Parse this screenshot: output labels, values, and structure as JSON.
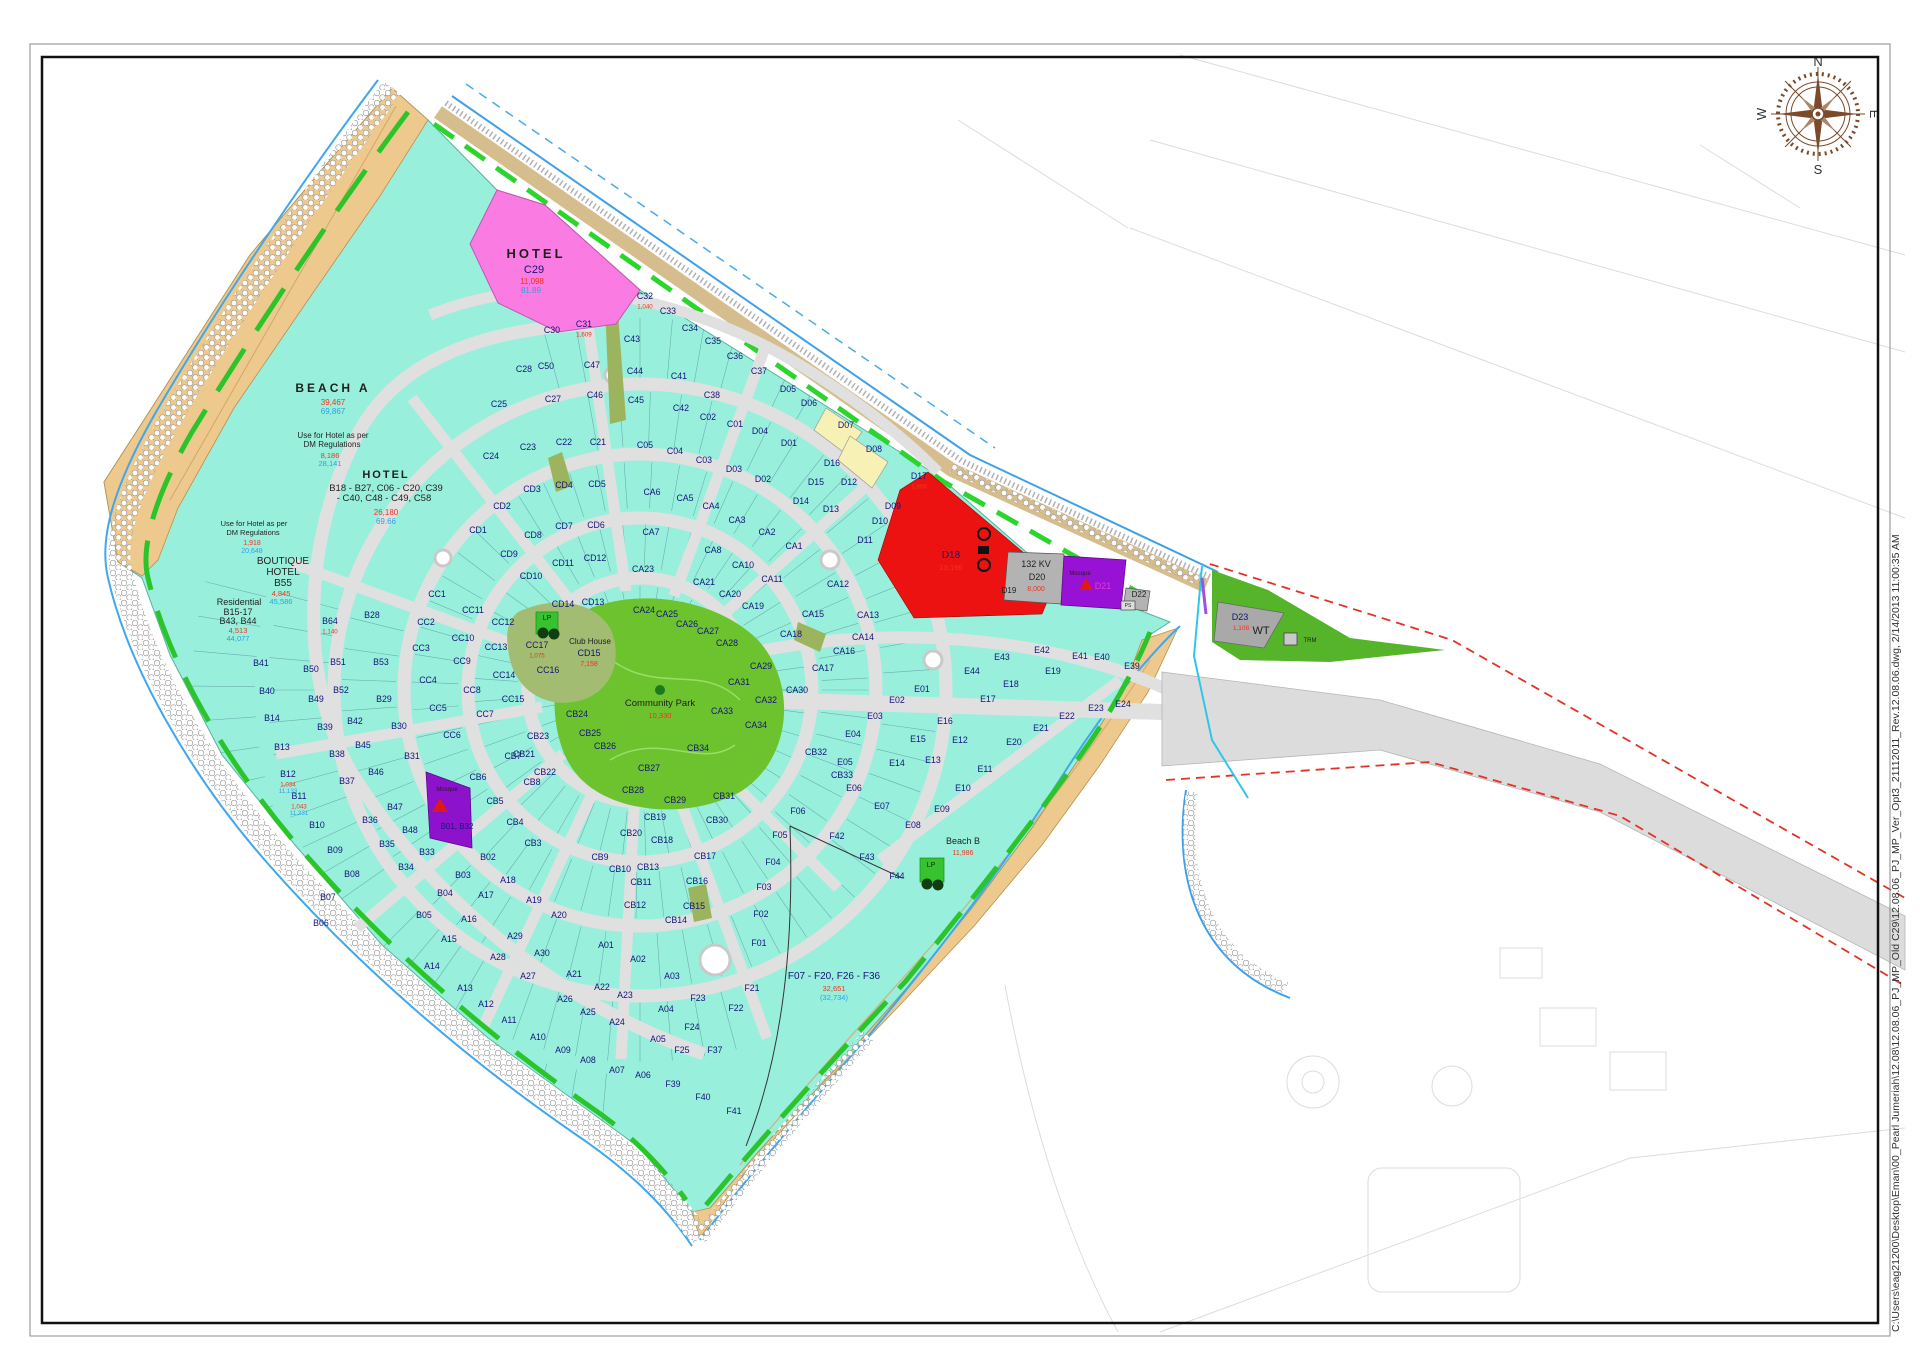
{
  "file_stamp": "C:\\Users\\eag21200\\Desktop\\Eman\\00_Pearl Jumeriah\\12.08\\12.08.06_PJ_MP_Old C29\\12.08.06_PJ_MP_Ver_Opt3_21112011_Rev.12.08.06.dwg, 2/14/2013 11:00:35 AM",
  "compass": {
    "n": "N",
    "e": "E",
    "s": "S",
    "w": "W"
  },
  "palette": {
    "plot_teal": "#98f0dc",
    "beach_tan": "#edc98e",
    "hotel_pink": "#fa7ce2",
    "utility_red": "#ed1212",
    "mosque_purple": "#9712d4",
    "park_green": "#6dc32d",
    "road_gray": "#e0e0e0",
    "code_navy": "#141478",
    "area_red": "#f2331e",
    "area_blue": "#2e9fe6"
  },
  "labels": [
    [
      "HOTEL",
      536,
      258,
      13,
      "k",
      1,
      3
    ],
    [
      "C29",
      534,
      273,
      11,
      "n",
      0,
      0
    ],
    [
      "11,098",
      532,
      284,
      8,
      "r",
      0,
      0
    ],
    [
      "81.89",
      531,
      293,
      8,
      "b",
      0,
      0
    ],
    [
      "BEACH A",
      333,
      392,
      12,
      "k",
      1,
      3
    ],
    [
      "39,467",
      333,
      405,
      8,
      "r",
      0,
      0
    ],
    [
      "69,867",
      333,
      414,
      8,
      "b",
      0,
      0
    ],
    [
      "Use for Hotel as per",
      333,
      438,
      8,
      "k",
      0,
      0
    ],
    [
      "DM Regulations",
      332,
      447,
      8,
      "k",
      0,
      0
    ],
    [
      "8,186",
      330,
      458,
      7.5,
      "r",
      0,
      0
    ],
    [
      "28,141",
      330,
      466,
      7.5,
      "b",
      0,
      0
    ],
    [
      "HOTEL",
      386,
      478,
      11,
      "k",
      1,
      2
    ],
    [
      "B18 - B27, C06 - C20, C39",
      386,
      491,
      9.5,
      "k",
      0,
      0
    ],
    [
      "- C40, C48 - C49, C58",
      384,
      501,
      9.5,
      "k",
      0,
      0
    ],
    [
      "26,180",
      386,
      515,
      8,
      "r",
      0,
      0
    ],
    [
      "69.66",
      386,
      524,
      8,
      "b",
      0,
      0
    ],
    [
      "Use for Hotel as per",
      254,
      526,
      7.5,
      "k",
      0,
      0
    ],
    [
      "DM Regulations",
      253,
      535,
      7.5,
      "k",
      0,
      0
    ],
    [
      "1,918",
      252,
      545,
      7,
      "r",
      0,
      0
    ],
    [
      "20,648",
      252,
      553,
      7,
      "b",
      0,
      0
    ],
    [
      "BOUTIQUE",
      283,
      564,
      10,
      "k",
      0,
      0
    ],
    [
      "HOTEL",
      283,
      575,
      10,
      "k",
      0,
      0
    ],
    [
      "B55",
      283,
      586,
      10,
      "k",
      0,
      0
    ],
    [
      "4,845",
      281,
      596,
      7.5,
      "r",
      0,
      0
    ],
    [
      "45,586",
      281,
      604,
      7.5,
      "b",
      0,
      0
    ],
    [
      "Residential",
      239,
      605,
      9,
      "k",
      0,
      0
    ],
    [
      "B15-17",
      238,
      615,
      9,
      "k",
      0,
      0
    ],
    [
      "B43, B44",
      238,
      624,
      9,
      "k",
      0,
      0
    ],
    [
      "4,513",
      238,
      633,
      7.5,
      "r",
      0,
      0
    ],
    [
      "44,077",
      238,
      641,
      7.5,
      "b",
      0,
      0
    ],
    [
      "D18",
      951,
      558,
      10,
      "n",
      0,
      0
    ],
    [
      "13,196",
      951,
      570,
      7.5,
      "r",
      0,
      0
    ],
    [
      "D19",
      1009,
      593,
      8,
      "k",
      0,
      0
    ],
    [
      "132 KV",
      1036,
      567,
      9,
      "k",
      0,
      0
    ],
    [
      "D20",
      1037,
      580,
      9,
      "k",
      0,
      0
    ],
    [
      "8,000",
      1036,
      591,
      7,
      "r",
      0,
      0
    ],
    [
      "Mosque",
      1080,
      575,
      6,
      "k",
      0,
      0
    ],
    [
      "D21",
      1103,
      589,
      9,
      "m",
      0,
      0
    ],
    [
      "D22",
      1139,
      597,
      8,
      "k",
      0,
      0
    ],
    [
      "PS",
      1128,
      607,
      5,
      "k",
      0,
      0
    ],
    [
      "D23",
      1240,
      620,
      9,
      "n",
      0,
      0
    ],
    [
      "1,108",
      1241,
      630,
      6.5,
      "r",
      0,
      0
    ],
    [
      "WT",
      1261,
      634,
      11,
      "k",
      0,
      0
    ],
    [
      "TRM",
      1310,
      642,
      6,
      "k",
      0,
      0
    ],
    [
      "LP",
      547,
      620,
      7,
      "k",
      0,
      0
    ],
    [
      "LP",
      931,
      867,
      7,
      "k",
      0,
      0
    ],
    [
      "Club House",
      590,
      644,
      8,
      "k",
      0,
      0
    ],
    [
      "CD15",
      589,
      656,
      9,
      "n",
      0,
      0
    ],
    [
      "7,158",
      589,
      666,
      7,
      "r",
      0,
      0
    ],
    [
      "Community Park",
      660,
      706,
      9.5,
      "k",
      0,
      0
    ],
    [
      "10,330",
      660,
      718,
      7.5,
      "r",
      0,
      0
    ],
    [
      "Beach B",
      963,
      844,
      9,
      "k",
      0,
      0
    ],
    [
      "11,986",
      963,
      855,
      7,
      "r",
      0,
      0
    ],
    [
      "F07 - F20,  F26 - F36",
      834,
      979,
      10,
      "n",
      0,
      0
    ],
    [
      "32,651",
      834,
      991,
      7.5,
      "r",
      0,
      0
    ],
    [
      "(32,734)",
      834,
      1000,
      7.5,
      "b",
      0,
      0
    ],
    [
      "Mosque",
      447,
      791,
      6,
      "k",
      0,
      0
    ],
    [
      "B01, B32",
      457,
      829,
      8,
      "n",
      0,
      0
    ]
  ],
  "plots": [
    [
      "C30",
      552,
      333
    ],
    [
      "C31",
      584,
      327,
      "1,609"
    ],
    [
      "C32",
      645,
      299,
      "1,040"
    ],
    [
      "C33",
      668,
      314
    ],
    [
      "C34",
      690,
      331
    ],
    [
      "C35",
      713,
      344
    ],
    [
      "C36",
      735,
      359
    ],
    [
      "C37",
      759,
      374
    ],
    [
      "C43",
      632,
      342
    ],
    [
      "C50",
      546,
      369
    ],
    [
      "C47",
      592,
      368
    ],
    [
      "C44",
      635,
      374
    ],
    [
      "C28",
      524,
      372
    ],
    [
      "C25",
      499,
      407
    ],
    [
      "C27",
      553,
      402
    ],
    [
      "C46",
      595,
      398
    ],
    [
      "C45",
      636,
      403
    ],
    [
      "C41",
      679,
      379
    ],
    [
      "C38",
      712,
      398
    ],
    [
      "C42",
      681,
      411
    ],
    [
      "C02",
      708,
      420
    ],
    [
      "C01",
      735,
      427
    ],
    [
      "C24",
      491,
      459
    ],
    [
      "C23",
      528,
      450
    ],
    [
      "C22",
      564,
      445
    ],
    [
      "C21",
      598,
      445
    ],
    [
      "C05",
      645,
      448
    ],
    [
      "C04",
      675,
      454
    ],
    [
      "C03",
      704,
      463
    ],
    [
      "D05",
      788,
      392
    ],
    [
      "D06",
      809,
      406
    ],
    [
      "D04",
      760,
      434
    ],
    [
      "D01",
      789,
      446
    ],
    [
      "D03",
      734,
      472
    ],
    [
      "D02",
      763,
      482
    ],
    [
      "D07",
      846,
      428
    ],
    [
      "D08",
      874,
      452
    ],
    [
      "D16",
      832,
      466
    ],
    [
      "D15",
      816,
      485
    ],
    [
      "D12",
      849,
      485
    ],
    [
      "D14",
      801,
      504
    ],
    [
      "D13",
      831,
      512
    ],
    [
      "D09",
      893,
      509
    ],
    [
      "D10",
      880,
      524
    ],
    [
      "D11",
      865,
      543
    ],
    [
      "D17",
      919,
      479,
      "1,858"
    ],
    [
      "CD1",
      478,
      533
    ],
    [
      "CD2",
      502,
      509
    ],
    [
      "CD3",
      532,
      492
    ],
    [
      "CD4",
      564,
      488
    ],
    [
      "CD5",
      597,
      487
    ],
    [
      "CD6",
      596,
      528
    ],
    [
      "CD7",
      564,
      529
    ],
    [
      "CD8",
      533,
      538
    ],
    [
      "CD9",
      509,
      557
    ],
    [
      "CD10",
      531,
      579
    ],
    [
      "CD11",
      563,
      566
    ],
    [
      "CD12",
      595,
      561
    ],
    [
      "CD13",
      593,
      605
    ],
    [
      "CD14",
      563,
      607
    ],
    [
      "CA1",
      794,
      549
    ],
    [
      "CA2",
      767,
      535
    ],
    [
      "CA3",
      737,
      523
    ],
    [
      "CA4",
      711,
      509
    ],
    [
      "CA5",
      685,
      501
    ],
    [
      "CA6",
      652,
      495
    ],
    [
      "CA7",
      651,
      535
    ],
    [
      "CA8",
      713,
      553
    ],
    [
      "CA10",
      743,
      568
    ],
    [
      "CA11",
      772,
      582
    ],
    [
      "CA12",
      838,
      587
    ],
    [
      "CA13",
      868,
      618
    ],
    [
      "CA14",
      863,
      640
    ],
    [
      "CA15",
      813,
      617
    ],
    [
      "CA16",
      844,
      654
    ],
    [
      "CA17",
      823,
      671
    ],
    [
      "CA18",
      791,
      637
    ],
    [
      "CA19",
      753,
      609
    ],
    [
      "CA20",
      730,
      597
    ],
    [
      "CA21",
      704,
      585
    ],
    [
      "CA23",
      643,
      572
    ],
    [
      "CA24",
      644,
      613
    ],
    [
      "CA25",
      667,
      617
    ],
    [
      "CA26",
      687,
      627
    ],
    [
      "CA27",
      708,
      634
    ],
    [
      "CA28",
      727,
      646
    ],
    [
      "CA29",
      761,
      669
    ],
    [
      "CA30",
      797,
      693
    ],
    [
      "CA31",
      739,
      685
    ],
    [
      "CA32",
      766,
      703
    ],
    [
      "CA33",
      722,
      714
    ],
    [
      "CA34",
      756,
      728
    ],
    [
      "CB34",
      698,
      751
    ],
    [
      "CC1",
      437,
      597
    ],
    [
      "CC2",
      426,
      625
    ],
    [
      "CC3",
      421,
      651
    ],
    [
      "CC4",
      428,
      683
    ],
    [
      "CC5",
      438,
      711
    ],
    [
      "CC6",
      452,
      738
    ],
    [
      "CC7",
      485,
      717
    ],
    [
      "CC8",
      472,
      693
    ],
    [
      "CC9",
      462,
      664
    ],
    [
      "CC10",
      463,
      641
    ],
    [
      "CC11",
      473,
      613
    ],
    [
      "CC12",
      503,
      625
    ],
    [
      "CC13",
      496,
      650
    ],
    [
      "CC14",
      504,
      678
    ],
    [
      "CC15",
      513,
      702
    ],
    [
      "CC16",
      548,
      673
    ],
    [
      "CC17",
      537,
      648,
      "1,075"
    ],
    [
      "CB23",
      538,
      739
    ],
    [
      "CB24",
      577,
      717
    ],
    [
      "CB25",
      590,
      736
    ],
    [
      "CB26",
      605,
      749
    ],
    [
      "CB27",
      649,
      771
    ],
    [
      "CB28",
      633,
      793
    ],
    [
      "CB21",
      524,
      757
    ],
    [
      "CB22",
      545,
      775
    ],
    [
      "CB19",
      655,
      820
    ],
    [
      "CB20",
      631,
      836
    ],
    [
      "CB9",
      600,
      860
    ],
    [
      "CB10",
      620,
      872
    ],
    [
      "CB11",
      641,
      885
    ],
    [
      "CB33",
      842,
      778
    ],
    [
      "CB32",
      816,
      755
    ],
    [
      "CB31",
      724,
      799
    ],
    [
      "CB29",
      675,
      803
    ],
    [
      "CB30",
      717,
      823
    ],
    [
      "CB18",
      662,
      843
    ],
    [
      "CB17",
      705,
      859
    ],
    [
      "CB13",
      648,
      870
    ],
    [
      "CB16",
      697,
      884
    ],
    [
      "CB15",
      694,
      909
    ],
    [
      "CB14",
      676,
      923
    ],
    [
      "CB12",
      635,
      908
    ],
    [
      "CB3",
      533,
      846
    ],
    [
      "CB4",
      515,
      825
    ],
    [
      "CB5",
      495,
      804
    ],
    [
      "CB6",
      478,
      780
    ],
    [
      "CB7",
      513,
      759
    ],
    [
      "CB8",
      532,
      785
    ],
    [
      "B64",
      330,
      624,
      "1,140"
    ],
    [
      "B28",
      372,
      618
    ],
    [
      "B41",
      261,
      666
    ],
    [
      "B50",
      311,
      672
    ],
    [
      "B51",
      338,
      665
    ],
    [
      "B53",
      381,
      665
    ],
    [
      "B40",
      267,
      694
    ],
    [
      "B49",
      316,
      702
    ],
    [
      "B52",
      341,
      693
    ],
    [
      "B29",
      384,
      702
    ],
    [
      "B14",
      272,
      721
    ],
    [
      "B39",
      325,
      730
    ],
    [
      "B42",
      355,
      724
    ],
    [
      "B30",
      399,
      729
    ],
    [
      "B13",
      282,
      750
    ],
    [
      "B38",
      337,
      757
    ],
    [
      "B45",
      363,
      748
    ],
    [
      "B31",
      412,
      759
    ],
    [
      "B12",
      288,
      777,
      "1,034",
      "11,133"
    ],
    [
      "B37",
      347,
      784
    ],
    [
      "B46",
      376,
      775
    ],
    [
      "B11",
      299,
      799,
      "1,043",
      "11,231"
    ],
    [
      "B10",
      317,
      828
    ],
    [
      "B36",
      370,
      823
    ],
    [
      "B47",
      395,
      810
    ],
    [
      "B48",
      410,
      833
    ],
    [
      "B35",
      387,
      847
    ],
    [
      "B09",
      335,
      853
    ],
    [
      "B34",
      406,
      870
    ],
    [
      "B08",
      352,
      877
    ],
    [
      "B33",
      427,
      855
    ],
    [
      "B07",
      328,
      900
    ],
    [
      "B06",
      321,
      926
    ],
    [
      "B03",
      463,
      878
    ],
    [
      "B02",
      488,
      860
    ],
    [
      "B04",
      445,
      896
    ],
    [
      "B05",
      424,
      918
    ],
    [
      "A18",
      508,
      883
    ],
    [
      "A17",
      486,
      898
    ],
    [
      "A19",
      534,
      903
    ],
    [
      "A20",
      559,
      918
    ],
    [
      "A16",
      469,
      922
    ],
    [
      "A15",
      449,
      942
    ],
    [
      "A29",
      515,
      939
    ],
    [
      "A30",
      542,
      956
    ],
    [
      "A28",
      498,
      960
    ],
    [
      "A27",
      528,
      979
    ],
    [
      "A21",
      574,
      977
    ],
    [
      "A14",
      432,
      969
    ],
    [
      "A13",
      465,
      991
    ],
    [
      "A12",
      486,
      1007
    ],
    [
      "A11",
      509,
      1023
    ],
    [
      "A10",
      538,
      1040
    ],
    [
      "A09",
      563,
      1053
    ],
    [
      "A08",
      588,
      1063
    ],
    [
      "A07",
      617,
      1073
    ],
    [
      "A06",
      643,
      1078
    ],
    [
      "A26",
      565,
      1002
    ],
    [
      "A25",
      588,
      1015
    ],
    [
      "A22",
      602,
      990
    ],
    [
      "A23",
      625,
      998
    ],
    [
      "A24",
      617,
      1025
    ],
    [
      "A01",
      606,
      948
    ],
    [
      "A02",
      638,
      962
    ],
    [
      "A03",
      672,
      979
    ],
    [
      "A04",
      666,
      1012
    ],
    [
      "A05",
      658,
      1042
    ],
    [
      "E01",
      922,
      692
    ],
    [
      "E02",
      897,
      703
    ],
    [
      "E03",
      875,
      719
    ],
    [
      "E04",
      853,
      737
    ],
    [
      "E05",
      845,
      765
    ],
    [
      "E06",
      854,
      791
    ],
    [
      "E07",
      882,
      809
    ],
    [
      "E08",
      913,
      828
    ],
    [
      "E09",
      942,
      812
    ],
    [
      "E10",
      963,
      791
    ],
    [
      "E11",
      985,
      772
    ],
    [
      "E12",
      960,
      743
    ],
    [
      "E13",
      933,
      763
    ],
    [
      "E14",
      897,
      766
    ],
    [
      "E15",
      918,
      742
    ],
    [
      "E16",
      945,
      724
    ],
    [
      "E17",
      988,
      702
    ],
    [
      "E18",
      1011,
      687
    ],
    [
      "E19",
      1053,
      674
    ],
    [
      "E20",
      1014,
      745
    ],
    [
      "E21",
      1041,
      731
    ],
    [
      "E22",
      1067,
      719
    ],
    [
      "E23",
      1096,
      711
    ],
    [
      "E24",
      1123,
      707
    ],
    [
      "E39",
      1132,
      669
    ],
    [
      "E40",
      1102,
      660
    ],
    [
      "E41",
      1080,
      659
    ],
    [
      "E42",
      1042,
      653
    ],
    [
      "E43",
      1002,
      660
    ],
    [
      "E44",
      972,
      674
    ],
    [
      "F01",
      759,
      946
    ],
    [
      "F02",
      761,
      917
    ],
    [
      "F03",
      764,
      890
    ],
    [
      "F04",
      773,
      865
    ],
    [
      "F05",
      780,
      838
    ],
    [
      "F06",
      798,
      814
    ],
    [
      "F21",
      752,
      991
    ],
    [
      "F22",
      736,
      1011
    ],
    [
      "F23",
      698,
      1001
    ],
    [
      "F24",
      692,
      1030
    ],
    [
      "F25",
      682,
      1053
    ],
    [
      "F37",
      715,
      1053
    ],
    [
      "F39",
      673,
      1087
    ],
    [
      "F40",
      703,
      1100
    ],
    [
      "F41",
      734,
      1114
    ],
    [
      "F42",
      837,
      839
    ],
    [
      "F43",
      867,
      860
    ],
    [
      "F44",
      897,
      879
    ]
  ]
}
